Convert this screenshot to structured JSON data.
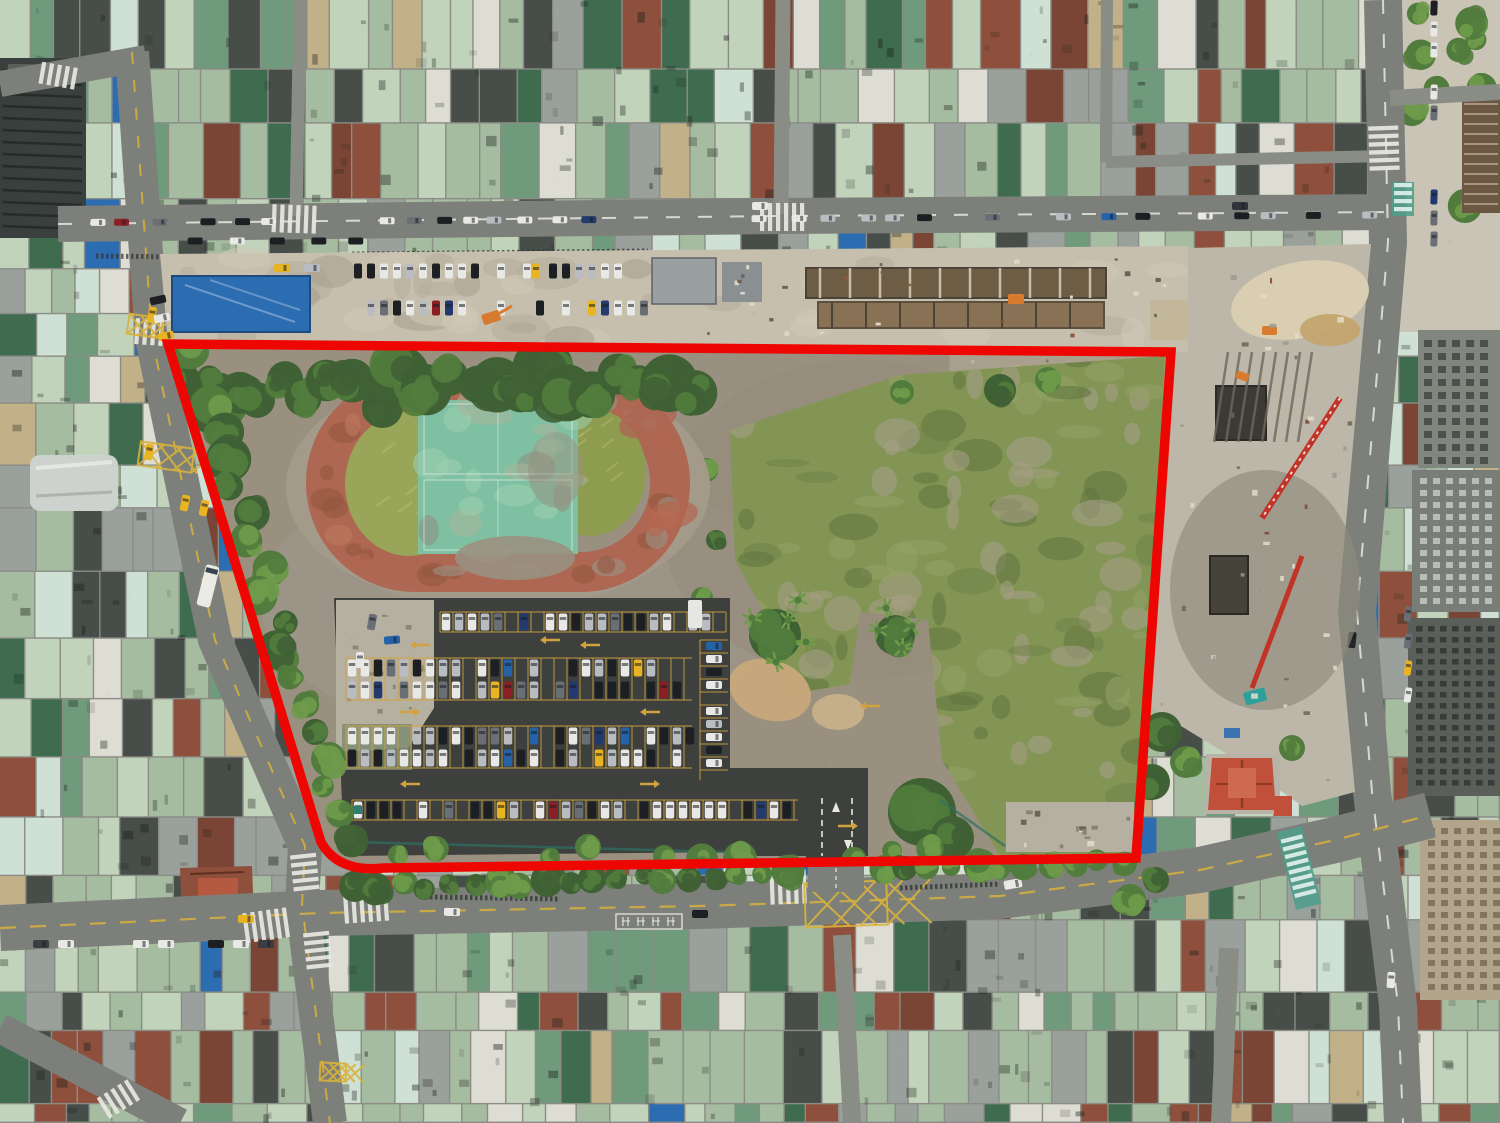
{
  "meta": {
    "type": "aerial-drone-photograph",
    "width": 1500,
    "height": 1123,
    "description": "Aerial drone photo of a dense urban district; a large cleared redevelopment site (old running track, faded sports court, car park, overgrown field, construction strips) is outlined with a thick red boundary."
  },
  "scene": {
    "site_boundary": {
      "label": "red site boundary outline",
      "stroke_width_px": 9.5
    },
    "features": {
      "running_track": "abandoned red running track with grass infield",
      "sports_court": "faded teal basketball courts inside track",
      "parking_lot": "surface car park with yellow stall lines",
      "overgrown_field": "weedy overgrown eastern field",
      "construction_north": "excavation strip north of site",
      "construction_east": "construction zone with cranes east of site",
      "city_blocks": "dense low-rise rooftops surrounding site",
      "roads": [
        "top road",
        "left slanted road",
        "bottom road",
        "right road"
      ]
    },
    "road_marking_box": {
      "label": "painted road text box (illegible characters)",
      "glyph_count": 4
    },
    "parking": {
      "stall_rows": 6,
      "aisle_arrow_color_key": "lot_line_yellow"
    }
  },
  "colors": {
    "boundary_red": "#ee0702",
    "road_asphalt": "#7d807a",
    "road_alley": "#8a8d86",
    "lot_asphalt": "#3e403e",
    "lot_line_yellow": "#d2a33c",
    "concrete": "#c6bfae",
    "concrete_bright": "#d9cdb2",
    "concrete_pad": "#b5b0a1",
    "dirt": "#9a9080",
    "dirt_tan": "#c9a87b",
    "track_red": "#ad6752",
    "track_red_light": "#c27a60",
    "track_red_dark": "#935640",
    "court_teal": "#7fc0a2",
    "court_teal_light": "#9ccfae",
    "grass_a": "#99a558",
    "grass_b": "#8e9c50",
    "grass_streak": "#b9bf72",
    "field_green": "#839555",
    "field_dark": "#5f7540",
    "field_grey": "#a8a08d",
    "tree_dark": "#3f6134",
    "tree_mid": "#527c3d",
    "tree_light": "#6f9b4a",
    "roof_sage": "#a6bca0",
    "roof_sage_light": "#c2d3bc",
    "roof_mint": "#cfe0d4",
    "roof_teal": "#6f9a7c",
    "roof_dark_green": "#3f6b4e",
    "roof_slate": "#474d49",
    "roof_grey": "#9aa09b",
    "roof_white": "#ddddd3",
    "roof_redbrown": "#8e4f3c",
    "roof_rust": "#7a4534",
    "roof_tan": "#c2b089",
    "tarp_blue": "#2c6cb0",
    "taxi_yellow": "#e9b422",
    "bus_white": "#eceae4",
    "marking_white": "#e8e8e2",
    "marking_yellow": "#d8b23c",
    "crosswalk_teal": "#4d9e8a",
    "crane_red": "#c23327",
    "machine_teal": "#2f9f9b",
    "machine_orange": "#d97b2e",
    "temple_roof": "#c0503a",
    "pit_dark": "#3c3a34",
    "building_grey": "#81867f",
    "building_grey_dark": "#5a5f5a",
    "building_beige": "#b3a58c",
    "building_brown": "#6b5742"
  },
  "car_palette": [
    "#e8e8e6",
    "#1d1f22",
    "#b9bcc0",
    "#6a6f75",
    "#233a6e",
    "#8c1f24",
    "#e9b422",
    "#2563a8"
  ],
  "car_weights": [
    0.33,
    0.22,
    0.2,
    0.1,
    0.05,
    0.04,
    0.03,
    0.03
  ]
}
